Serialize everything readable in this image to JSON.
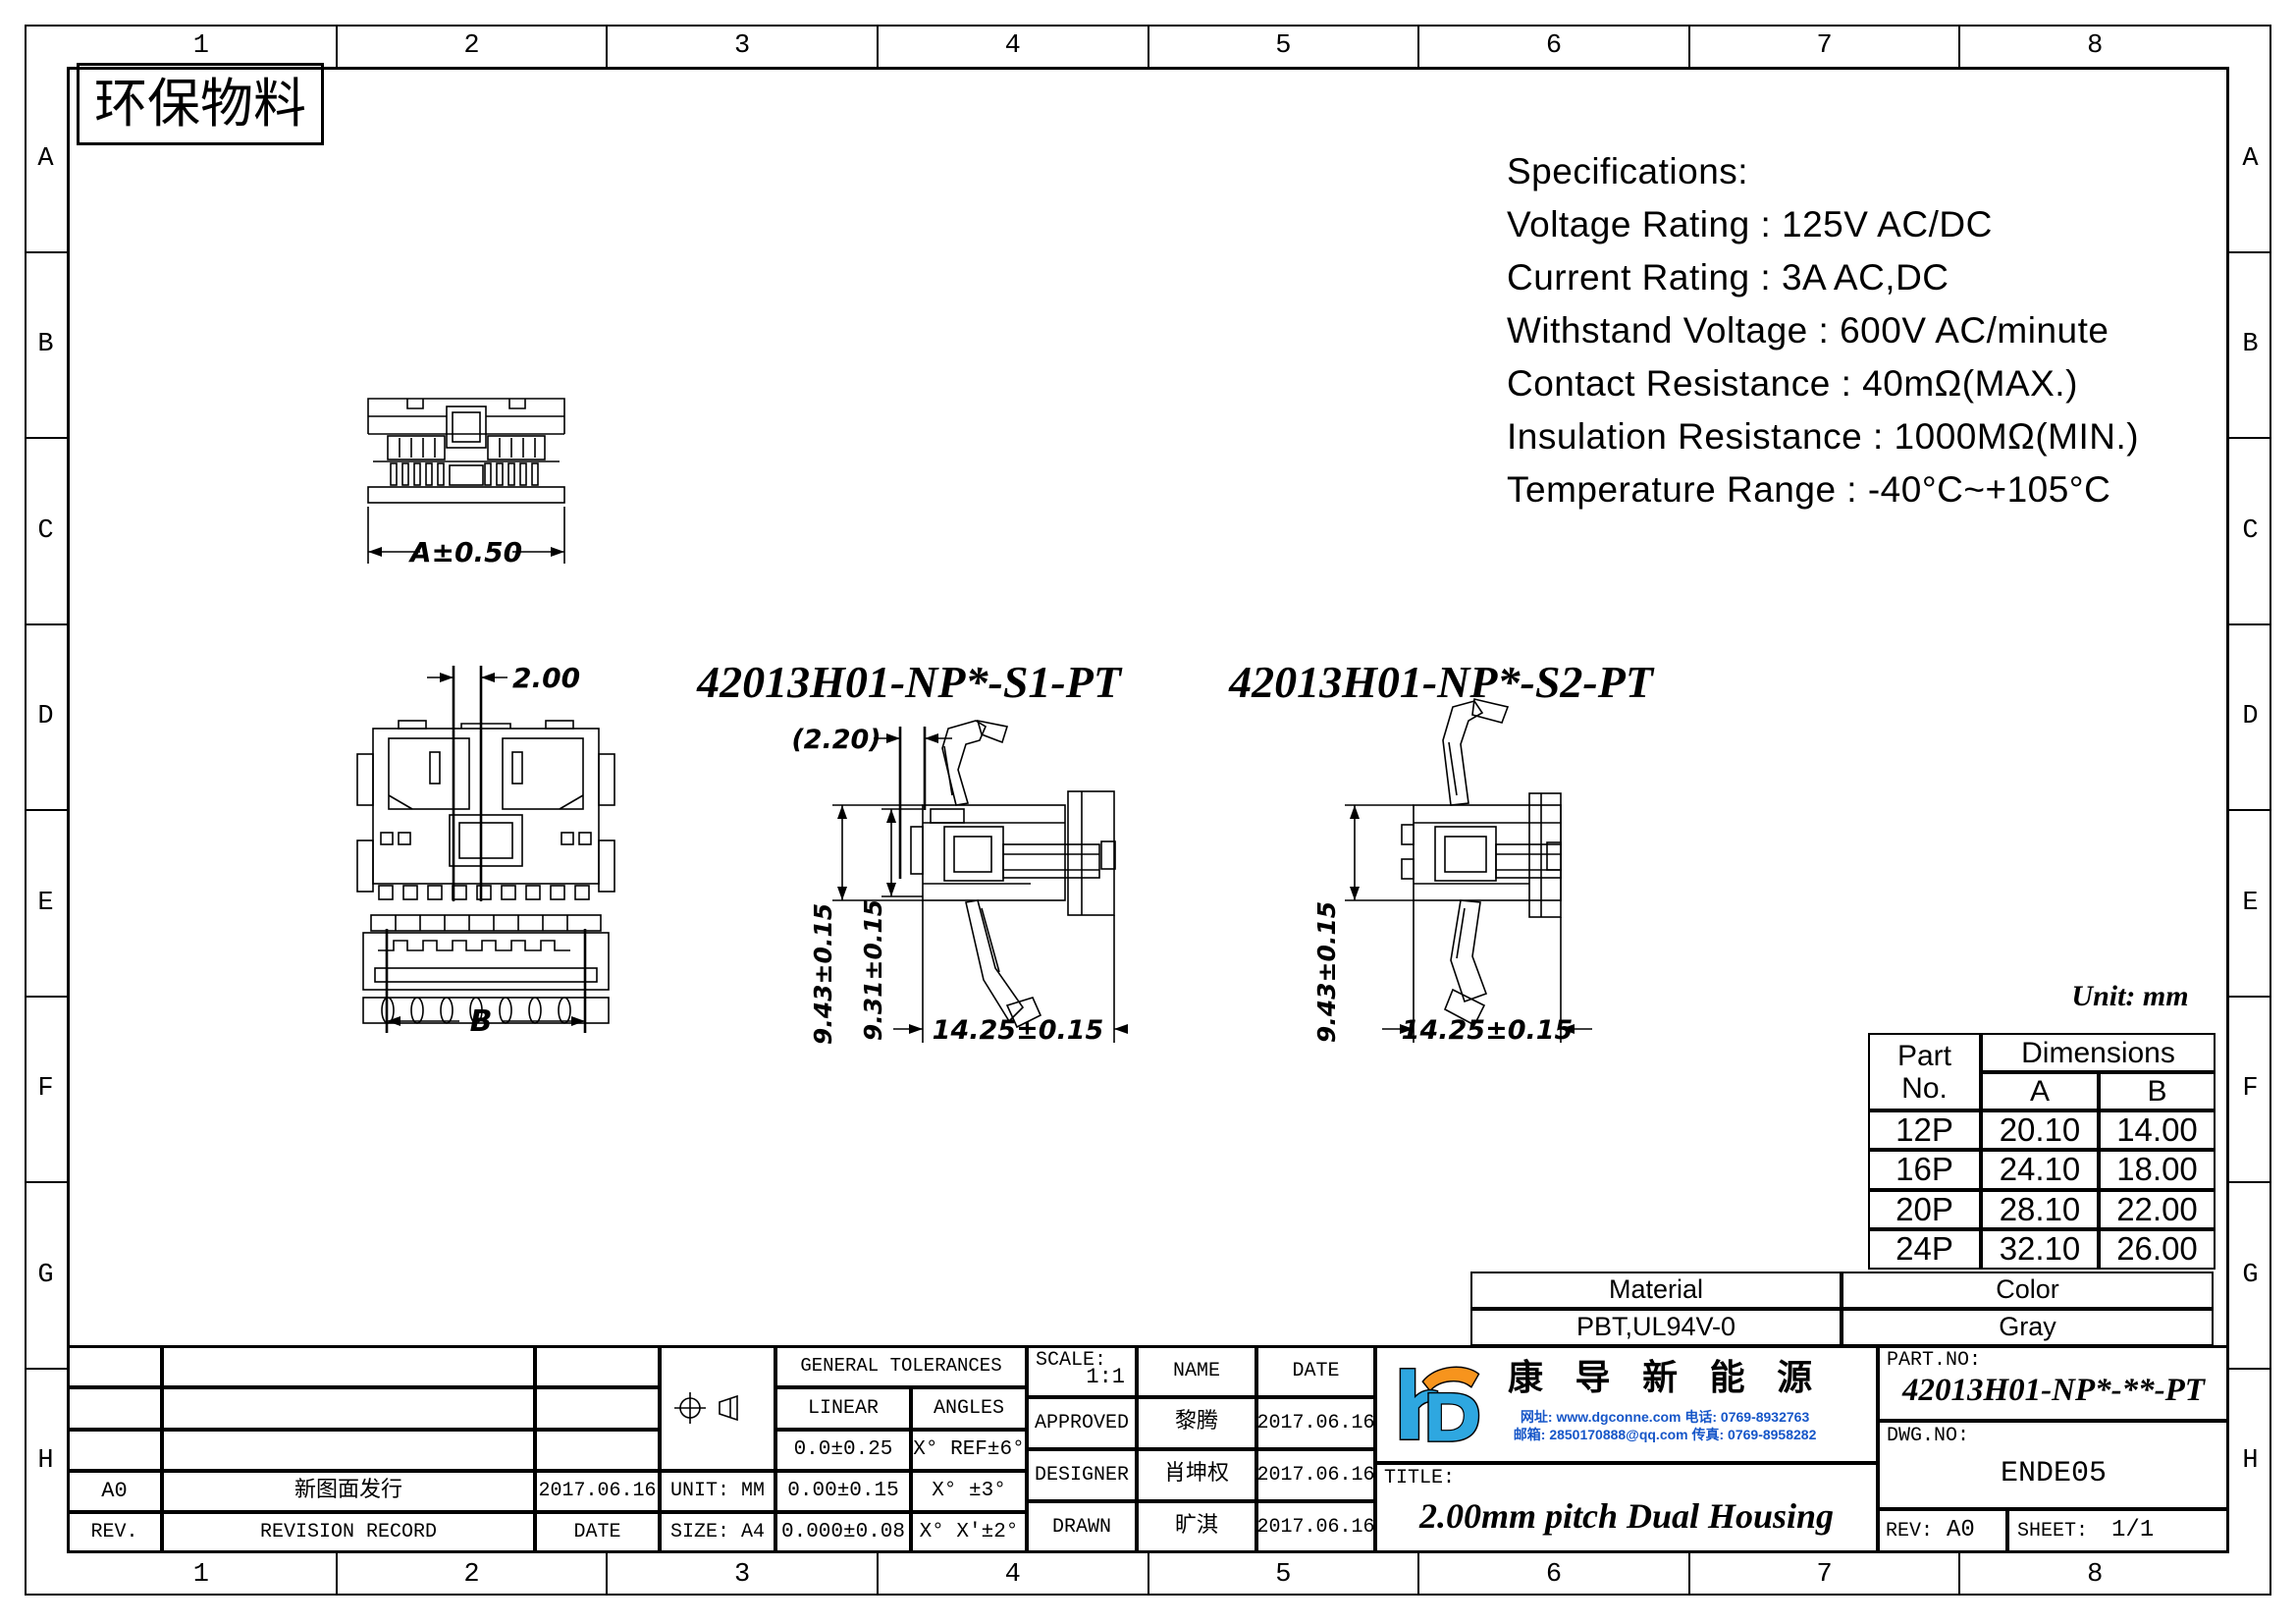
{
  "frame": {
    "grid_columns": [
      "1",
      "2",
      "3",
      "4",
      "5",
      "6",
      "7",
      "8"
    ],
    "grid_rows": [
      "A",
      "B",
      "C",
      "D",
      "E",
      "F",
      "G",
      "H"
    ]
  },
  "header": {
    "eco_label": "环保物料"
  },
  "specifications": {
    "title": "Specifications:",
    "lines": [
      "Voltage Rating : 125V AC/DC",
      "Current Rating : 3A AC,DC",
      "Withstand Voltage : 600V AC/minute",
      "Contact Resistance : 40mΩ(MAX.)",
      "Insulation Resistance : 1000MΩ(MIN.)",
      "Temperature Range : -40°C~+105°C"
    ]
  },
  "part_labels": {
    "s1": "42013H01-NP*-S1-PT",
    "s2": "42013H01-NP*-S2-PT"
  },
  "drawing_dims": {
    "front_width": "A±0.50",
    "pitch": "2.00",
    "bottom_width": "B",
    "s1_ref": "(2.20)",
    "s1_height_outer": "9.43±0.15",
    "s1_height_inner": "9.31±0.15",
    "s1_width": "14.25±0.15",
    "s2_height": "9.43±0.15",
    "s2_width": "14.25±0.15"
  },
  "unit_note": "Unit: mm",
  "dimensions_table": {
    "col_part_line1": "Part",
    "col_part_line2": "No.",
    "col_dims": "Dimensions",
    "col_a": "A",
    "col_b": "B",
    "rows": [
      {
        "part": "12P",
        "a": "20.10",
        "b": "14.00"
      },
      {
        "part": "16P",
        "a": "24.10",
        "b": "18.00"
      },
      {
        "part": "20P",
        "a": "28.10",
        "b": "22.00"
      },
      {
        "part": "24P",
        "a": "32.10",
        "b": "26.00"
      }
    ]
  },
  "material_table": {
    "material_label": "Material",
    "color_label": "Color",
    "material_value": "PBT,UL94V-0",
    "color_value": "Gray"
  },
  "title_block": {
    "revision": {
      "rev_value": "A0",
      "record_value": "新图面发行",
      "date_value": "2017.06.16",
      "rev_label": "REV.",
      "record_label": "REVISION RECORD",
      "date_label": "DATE"
    },
    "unit_label": "UNIT: MM",
    "size_label": "SIZE: A4",
    "tolerances": {
      "title": "GENERAL TOLERANCES",
      "linear_label": "LINEAR",
      "angles_label": "ANGLES",
      "rows": [
        {
          "linear": "0.0±0.25",
          "angles": "X° REF±6°"
        },
        {
          "linear": "0.00±0.15",
          "angles": "X° ±3°"
        },
        {
          "linear": "0.000±0.08",
          "angles": "X° X'±2°"
        }
      ]
    },
    "scale_label": "SCALE:",
    "scale_value": "1:1",
    "name_label": "NAME",
    "date_label": "DATE",
    "signoff": [
      {
        "role": "APPROVED",
        "name": "黎腾",
        "date": "2017.06.16"
      },
      {
        "role": "DESIGNER",
        "name": "肖坤权",
        "date": "2017.06.16"
      },
      {
        "role": "DRAWN",
        "name": "旷淇",
        "date": "2017.06.16"
      }
    ],
    "company": {
      "name": "康 导 新 能 源",
      "contact_line1": "网址: www.dgconne.com  电话: 0769-8932763",
      "contact_line2": "邮箱: 2850170888@qq.com 传真: 0769-8958282"
    },
    "title_label": "TITLE:",
    "title_value": "2.00mm pitch Dual Housing",
    "part_no_label": "PART.NO:",
    "part_no_value": "42013H01-NP*-**-PT",
    "dwg_no_label": "DWG.NO:",
    "dwg_no_value": "ENDE05",
    "rev_label": "REV:",
    "rev_value": "A0",
    "sheet_label": "SHEET:",
    "sheet_value": "1/1"
  },
  "colors": {
    "logo_blue": "#2EA7E0",
    "logo_orange": "#F7941D",
    "contact_blue": "#1656C8",
    "line_black": "#000000"
  }
}
